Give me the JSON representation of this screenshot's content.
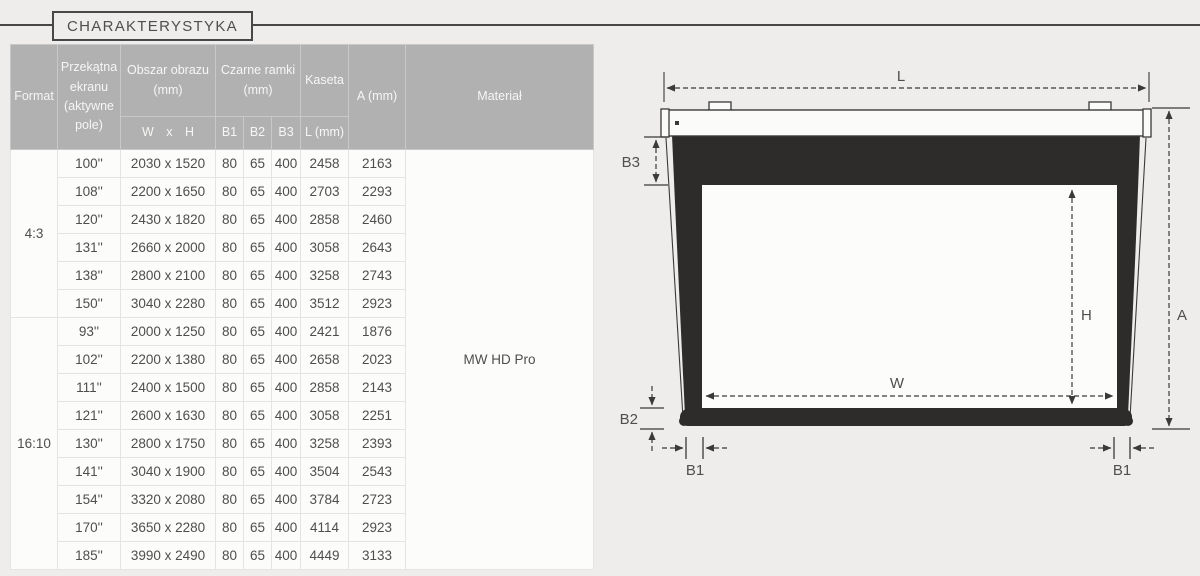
{
  "page": {
    "title": "CHARAKTERYSTYKA"
  },
  "table": {
    "headers": {
      "format": "Format",
      "diagonal": "Przekątna ekranu (aktywne pole)",
      "image_area": "Obszar obrazu (mm)",
      "image_area_sub": "W x H",
      "black_frames": "Czarne ramki (mm)",
      "b1": "B1",
      "b2": "B2",
      "b3": "B3",
      "kaseta": "Kaseta",
      "kaseta_sub": "L (mm)",
      "a": "A (mm)",
      "material": "Materiał"
    },
    "material_value": "MW HD Pro",
    "groups": [
      {
        "format": "4:3",
        "rows": [
          {
            "diagonal": "100''",
            "area": "2030 x 1520",
            "b1": "80",
            "b2": "65",
            "b3": "400",
            "l": "2458",
            "a": "2163"
          },
          {
            "diagonal": "108''",
            "area": "2200 x 1650",
            "b1": "80",
            "b2": "65",
            "b3": "400",
            "l": "2703",
            "a": "2293"
          },
          {
            "diagonal": "120''",
            "area": "2430 x 1820",
            "b1": "80",
            "b2": "65",
            "b3": "400",
            "l": "2858",
            "a": "2460"
          },
          {
            "diagonal": "131''",
            "area": "2660 x 2000",
            "b1": "80",
            "b2": "65",
            "b3": "400",
            "l": "3058",
            "a": "2643"
          },
          {
            "diagonal": "138''",
            "area": "2800 x 2100",
            "b1": "80",
            "b2": "65",
            "b3": "400",
            "l": "3258",
            "a": "2743"
          },
          {
            "diagonal": "150''",
            "area": "3040 x 2280",
            "b1": "80",
            "b2": "65",
            "b3": "400",
            "l": "3512",
            "a": "2923"
          }
        ]
      },
      {
        "format": "16:10",
        "rows": [
          {
            "diagonal": "93''",
            "area": "2000 x 1250",
            "b1": "80",
            "b2": "65",
            "b3": "400",
            "l": "2421",
            "a": "1876"
          },
          {
            "diagonal": "102''",
            "area": "2200 x 1380",
            "b1": "80",
            "b2": "65",
            "b3": "400",
            "l": "2658",
            "a": "2023"
          },
          {
            "diagonal": "111''",
            "area": "2400 x 1500",
            "b1": "80",
            "b2": "65",
            "b3": "400",
            "l": "2858",
            "a": "2143"
          },
          {
            "diagonal": "121''",
            "area": "2600 x 1630",
            "b1": "80",
            "b2": "65",
            "b3": "400",
            "l": "3058",
            "a": "2251"
          },
          {
            "diagonal": "130''",
            "area": "2800 x 1750",
            "b1": "80",
            "b2": "65",
            "b3": "400",
            "l": "3258",
            "a": "2393"
          },
          {
            "diagonal": "141''",
            "area": "3040 x 1900",
            "b1": "80",
            "b2": "65",
            "b3": "400",
            "l": "3504",
            "a": "2543"
          },
          {
            "diagonal": "154''",
            "area": "3320 x 2080",
            "b1": "80",
            "b2": "65",
            "b3": "400",
            "l": "3784",
            "a": "2723"
          },
          {
            "diagonal": "170''",
            "area": "3650 x 2280",
            "b1": "80",
            "b2": "65",
            "b3": "400",
            "l": "4114",
            "a": "2923"
          },
          {
            "diagonal": "185''",
            "area": "3990 x 2490",
            "b1": "80",
            "b2": "65",
            "b3": "400",
            "l": "4449",
            "a": "3133"
          }
        ]
      }
    ]
  },
  "diagram": {
    "labels": {
      "l": "L",
      "a": "A",
      "h": "H",
      "w": "W",
      "b1": "B1",
      "b2": "B2",
      "b3": "B3"
    }
  }
}
